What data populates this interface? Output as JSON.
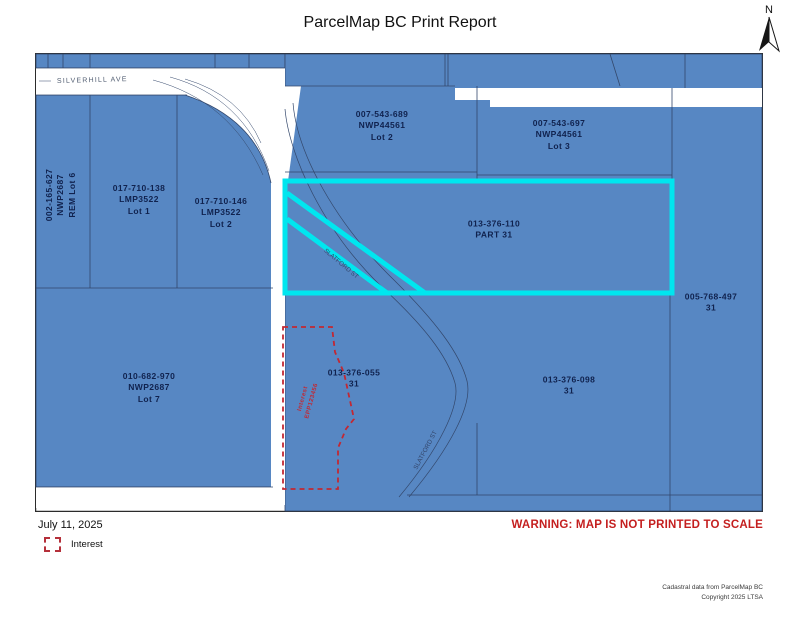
{
  "title": "ParcelMap BC Print Report",
  "north": {
    "label": "N"
  },
  "map": {
    "streets": {
      "silverhill": "SILVERHILL AVE",
      "slatford_upper": "SLATFORD ST",
      "slatford_lower": "SLATFORD ST"
    },
    "parcels": {
      "rem_lot6": {
        "line1": "002-165-627",
        "line2": "NWP2687",
        "line3": "REM Lot 6"
      },
      "lmp_lot1": {
        "line1": "017-710-138",
        "line2": "LMP3522",
        "line3": "Lot 1"
      },
      "lmp_lot2": {
        "line1": "017-710-146",
        "line2": "LMP3522",
        "line3": "Lot 2"
      },
      "nwp_lot2": {
        "line1": "007-543-689",
        "line2": "NWP44561",
        "line3": "Lot 2"
      },
      "nwp_lot3": {
        "line1": "007-543-697",
        "line2": "NWP44561",
        "line3": "Lot 3"
      },
      "part31": {
        "line1": "013-376-110",
        "line2": "PART 31"
      },
      "p497": {
        "line1": "005-768-497",
        "line2": "31"
      },
      "lot7": {
        "line1": "010-682-970",
        "line2": "NWP2687",
        "line3": "Lot 7"
      },
      "p055": {
        "line1": "013-376-055",
        "line2": "31"
      },
      "p098": {
        "line1": "013-376-098",
        "line2": "31"
      }
    },
    "interest_label": {
      "line1": "Interest",
      "line2": "EPP123456"
    }
  },
  "footer": {
    "date": "July 11, 2025",
    "legend_label": "Interest",
    "warning": "WARNING: MAP IS NOT PRINTED TO SCALE",
    "credit_line1": "Cadastral data from ParcelMap BC",
    "credit_line2": "Copyright 2025 LTSA"
  },
  "colors": {
    "parcel_blue": "#5787c3",
    "boundary": "#33476b",
    "highlight_cyan": "#00e6ef",
    "interest_red": "#c22833",
    "warning_red": "#c41f1f",
    "label_navy": "#10224e"
  }
}
